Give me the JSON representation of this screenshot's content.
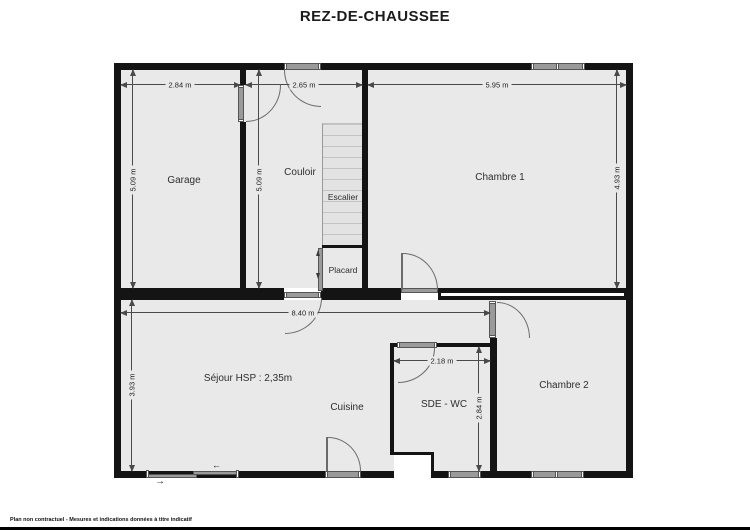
{
  "title": "REZ-DE-CHAUSSEE",
  "footer": "Plan non contractuel - Mesures et indications données à titre indicatif",
  "rooms": {
    "garage": "Garage",
    "couloir": "Couloir",
    "escalier": "Escalier",
    "chambre1": "Chambre 1",
    "placard": "Placard",
    "sejour": "Séjour HSP : 2,35m",
    "cuisine": "Cuisine",
    "sde_wc": "SDE - WC",
    "chambre2": "Chambre 2"
  },
  "dimensions": {
    "garage_width": "2.84 m",
    "couloir_width": "2.65 m",
    "chambre1_width": "5.95 m",
    "garage_height": "5.09 m",
    "couloir_height": "5.09 m",
    "chambre1_height": "4.93 m",
    "sejour_width": "8.40 m",
    "sejour_height": "3.93 m",
    "sde_wc_width": "2.18 m",
    "sde_wc_height": "2.84 m"
  },
  "symbols": {
    "entrance_arrow": "→",
    "slide_arrow": "←"
  },
  "colors": {
    "wall": "#141414",
    "floor": "#e9e9e9",
    "fixture_gray": "#9a9a9a",
    "dimension_line": "#4a4a4a"
  }
}
